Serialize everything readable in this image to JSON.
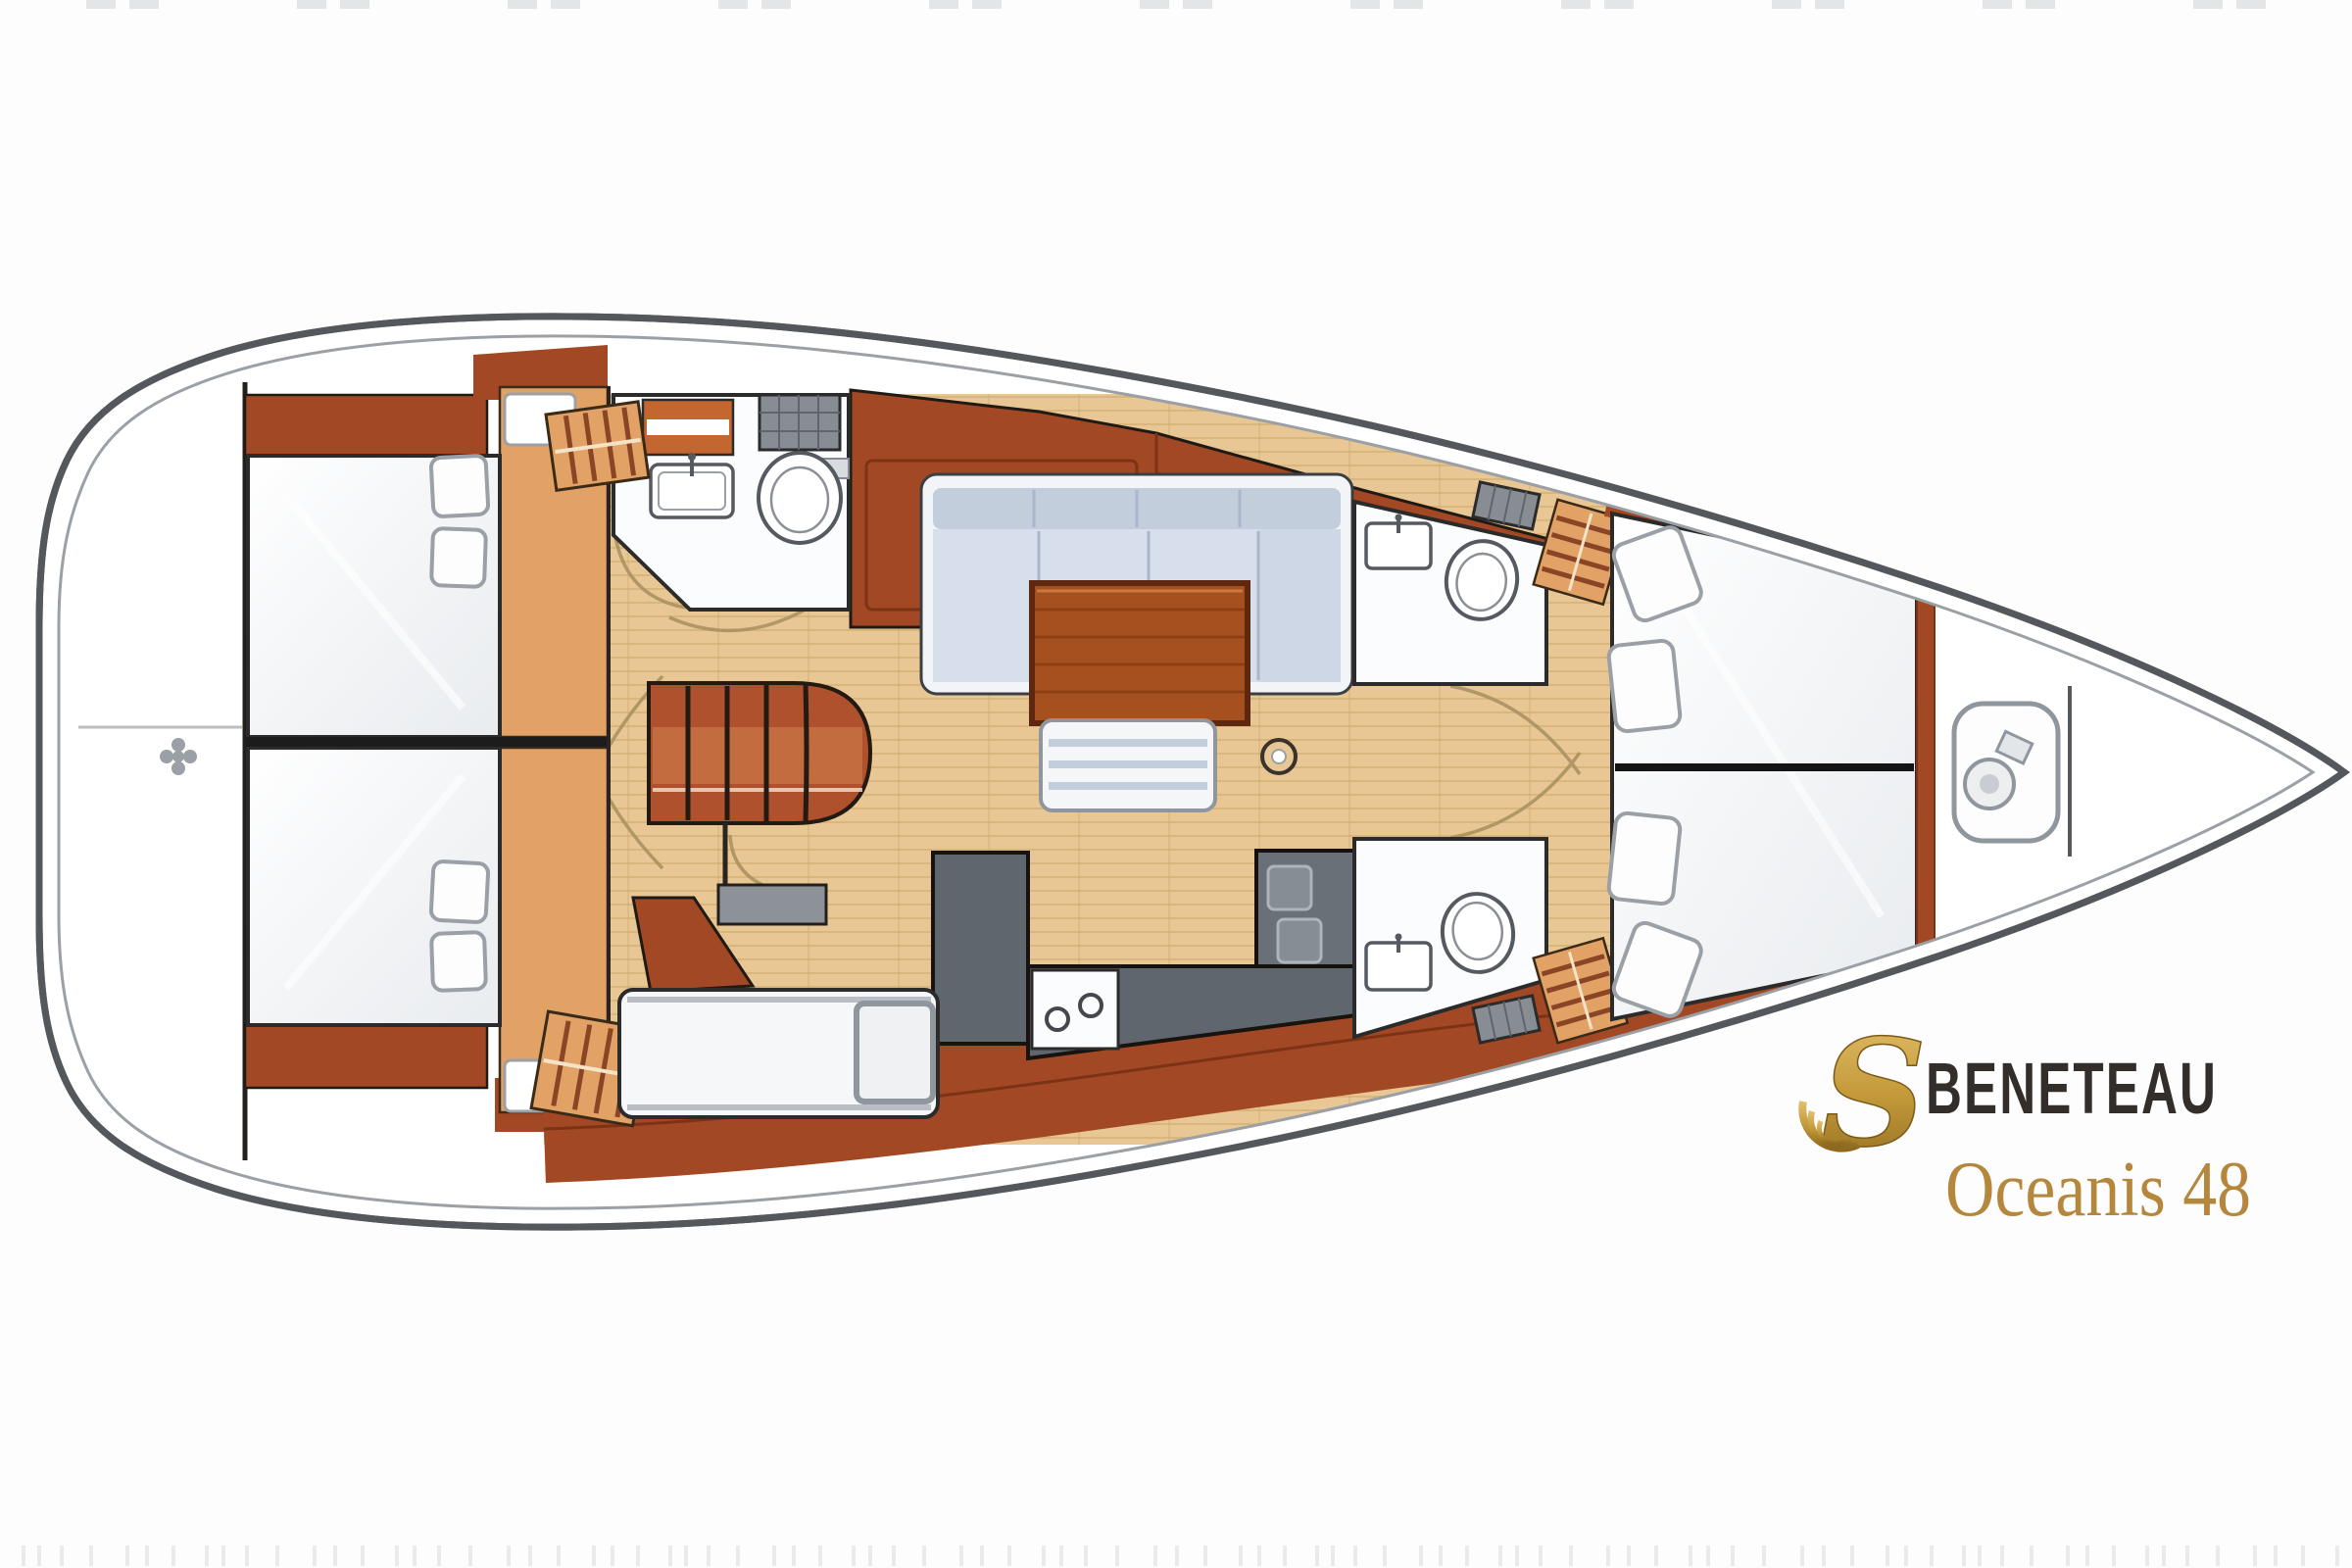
{
  "page": {
    "background": "#fdfdfd",
    "kind": "sailboat interior deck plan"
  },
  "brand": {
    "logo_icon": "seahorse-s-icon",
    "logo_glyph": "S",
    "wordmark": "BENETEAU",
    "model": "Oceanis 48",
    "wordmark_color": "#332e2a",
    "model_color": "#b5873d",
    "gold_light": "#dcb65e",
    "gold_dark": "#9c741f"
  },
  "palette": {
    "hull_outline": "#54585d",
    "inner_deck_line": "#9aa0a5",
    "floor_wood": "#e8c795",
    "floor_grain": "#d9b67c",
    "mahogany": "#a34824",
    "mahogany_dark": "#7c3214",
    "oak_locker": "#e2a266",
    "counter_gray": "#60666e",
    "stove_gray": "#6a7078",
    "sofa_blue": "#d7dfed",
    "sofa_blue_dark": "#c3cedd",
    "berth_white": "#f7f8fa",
    "table_wood": "#a6501f",
    "arc_tan": "#ab9260"
  }
}
